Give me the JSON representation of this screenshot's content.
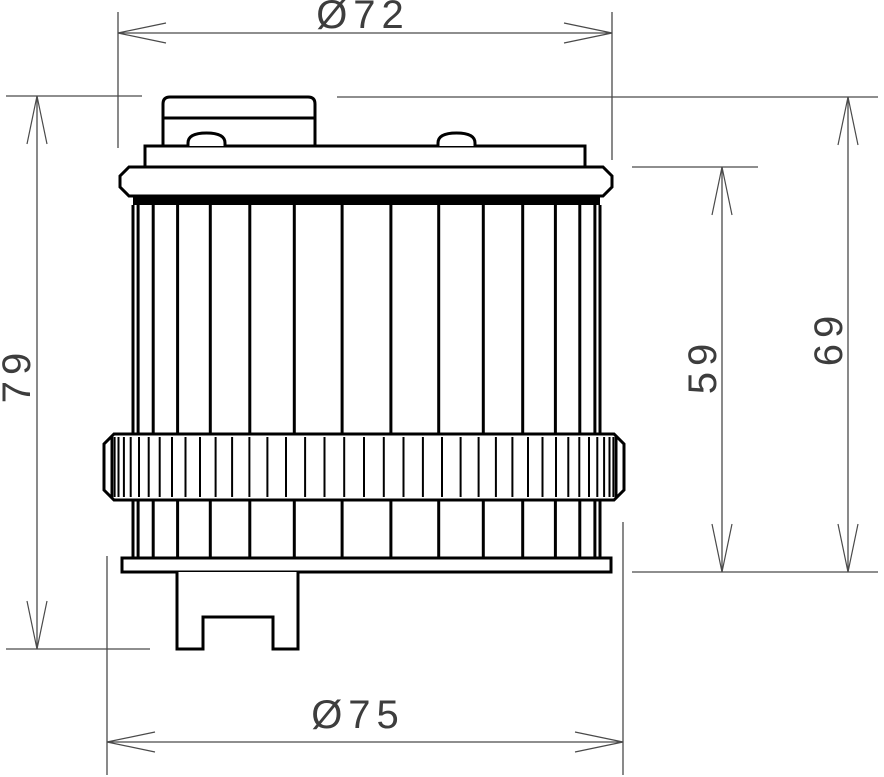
{
  "drawing": {
    "background_color": "#ffffff",
    "outline_color": "#000000",
    "dimension_color": "#4a4a4a",
    "dimensions": {
      "top_diameter": "Ø72",
      "bottom_diameter": "Ø75",
      "overall_height_left": "79",
      "body_height_inner_right": "59",
      "body_height_outer_right": "69"
    }
  }
}
